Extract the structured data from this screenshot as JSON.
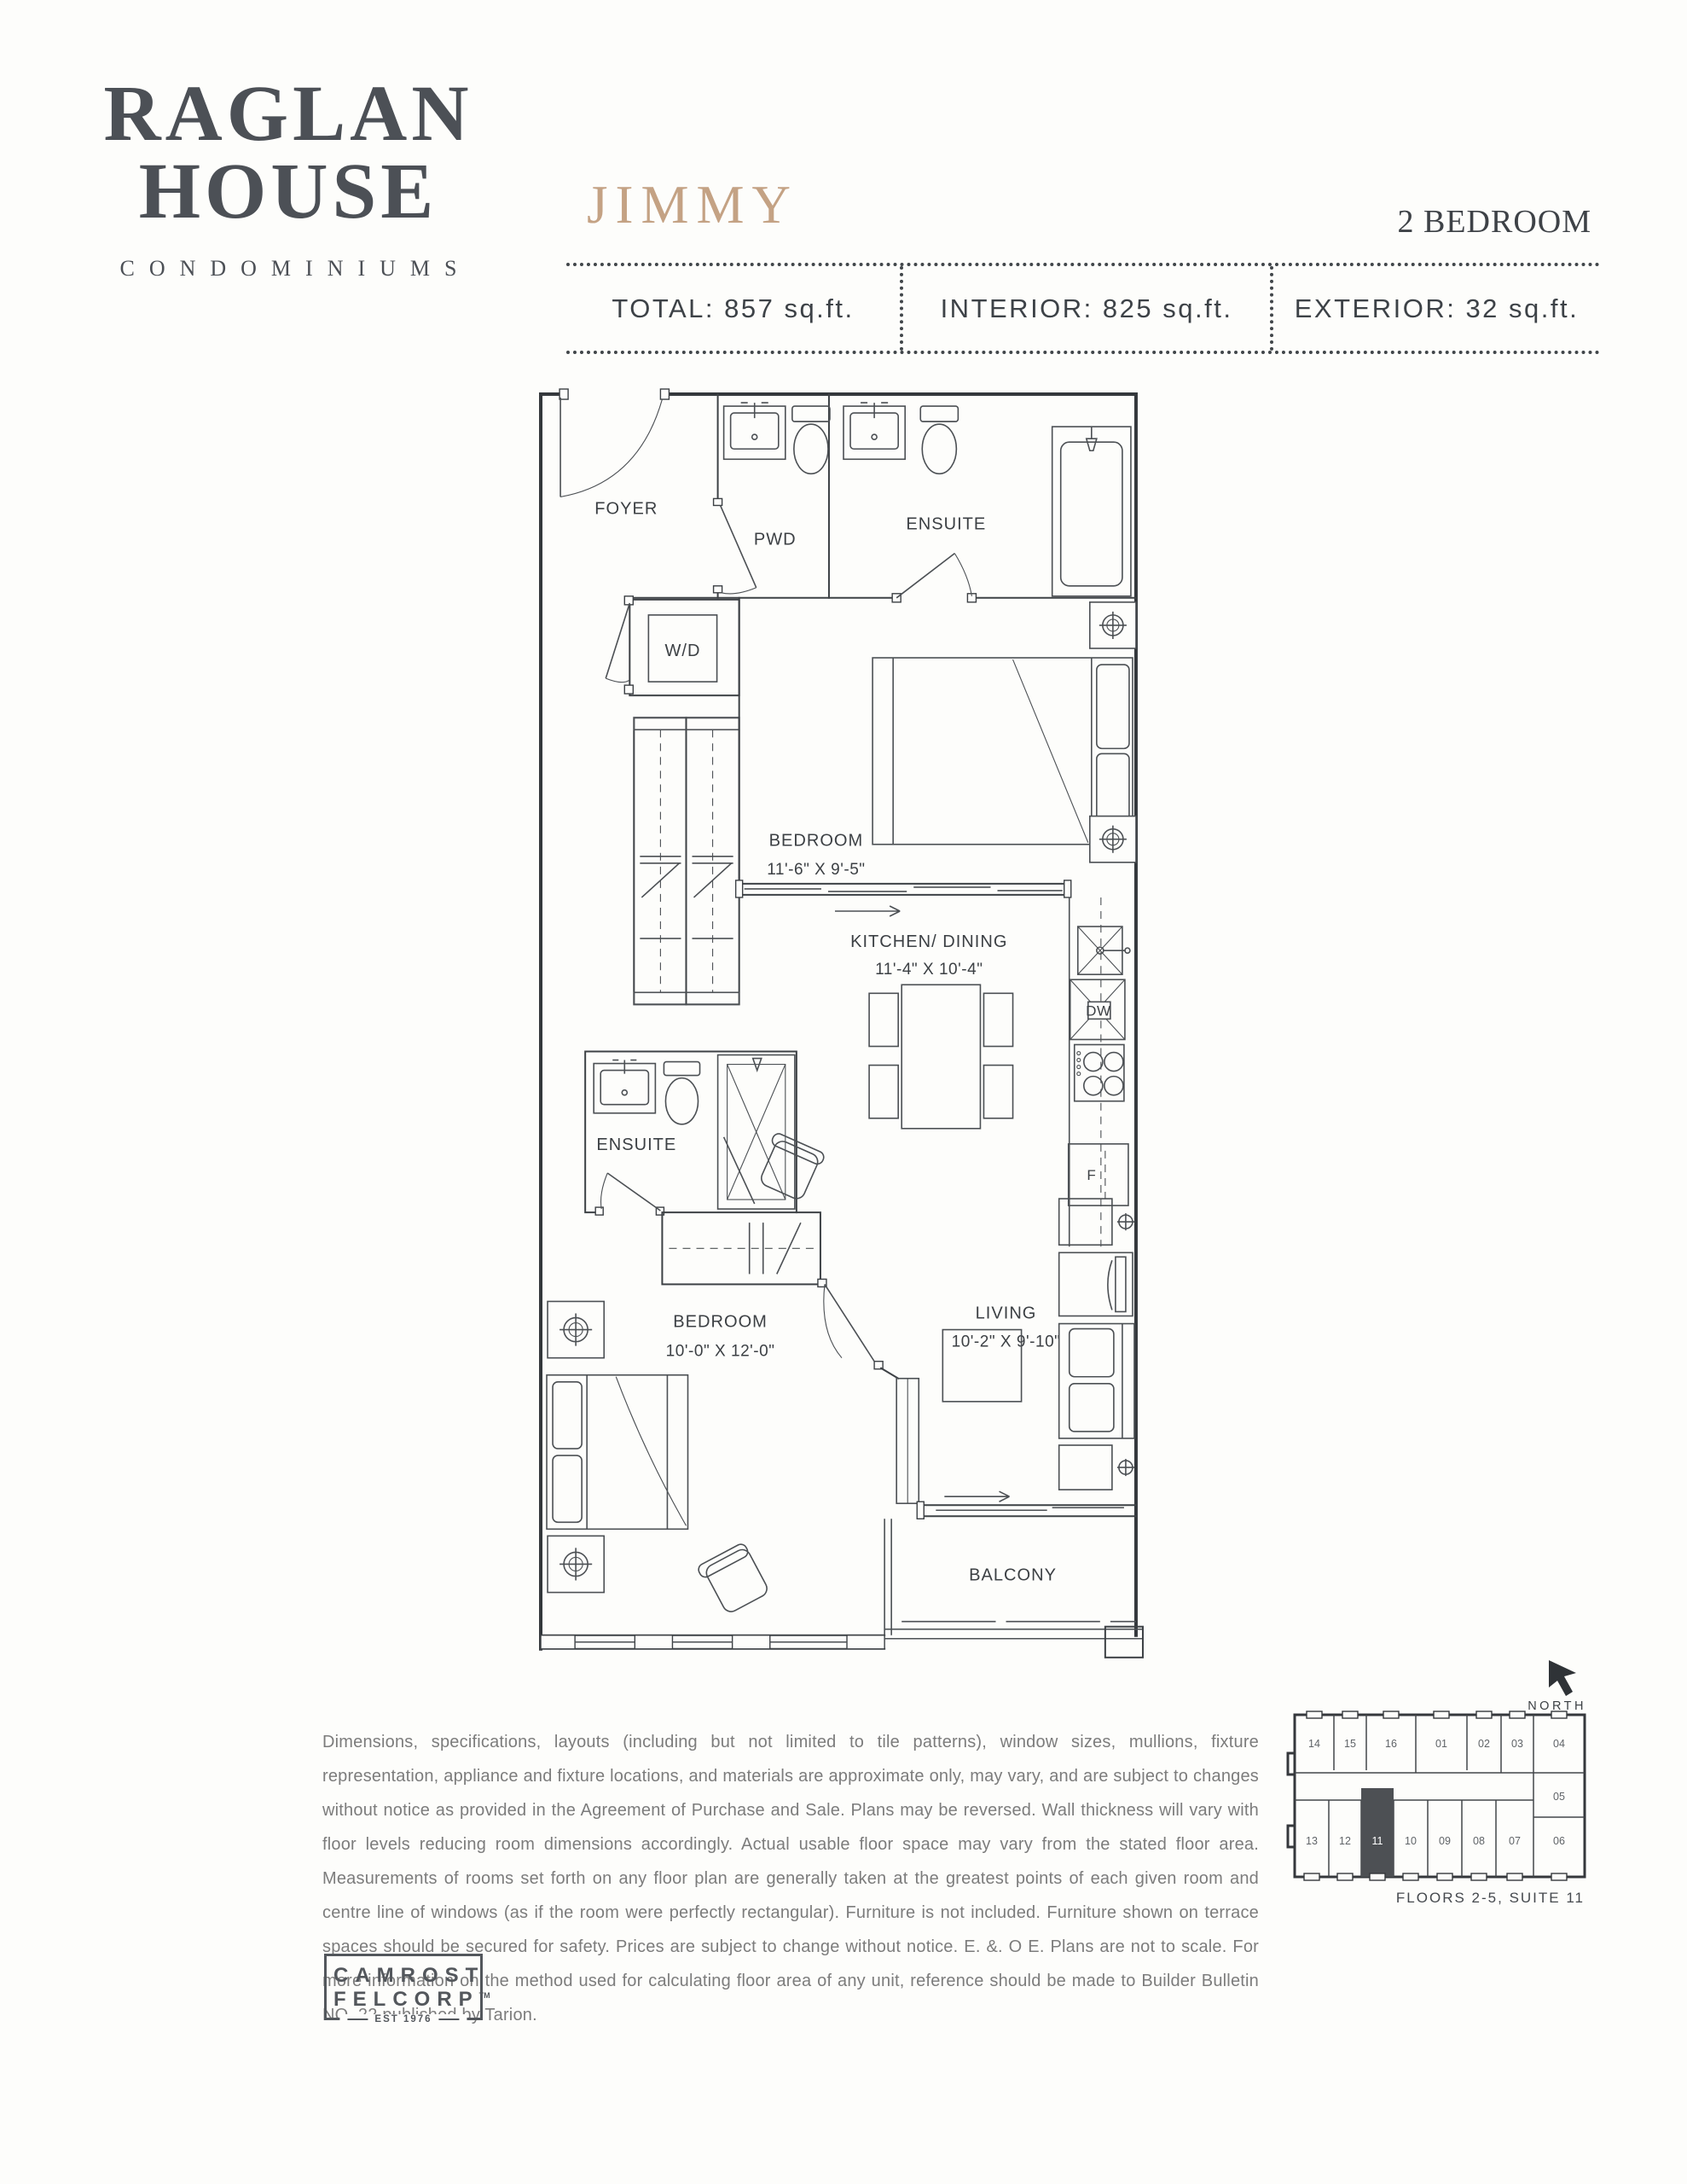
{
  "brand": {
    "name_line1": "RAGLAN",
    "name_line2": "HOUSE",
    "subtitle": "CONDOMINIUMS"
  },
  "header": {
    "plan_name": "JIMMY",
    "plan_type": "2 BEDROOM",
    "stats": [
      "TOTAL: 857 sq.ft.",
      "INTERIOR: 825 sq.ft.",
      "EXTERIOR: 32 sq.ft."
    ]
  },
  "floorplan": {
    "labels": {
      "foyer": "FOYER",
      "pwd": "PWD",
      "ensuite_top": "ENSUITE",
      "wd": "W/D",
      "bedroom1": "BEDROOM",
      "bedroom1_dims": "11'-6\" X 9'-5\"",
      "kitchen": "KITCHEN/ DINING",
      "kitchen_dims": "11'-4\" X 10'-4\"",
      "dw": "DW",
      "fridge": "F",
      "ensuite_lower": "ENSUITE",
      "bedroom2": "BEDROOM",
      "bedroom2_dims": "10'-0\" X 12'-0\"",
      "living": "LIVING",
      "living_dims": "10'-2\" X 9'-10\"",
      "balcony": "BALCONY"
    }
  },
  "keyplan": {
    "north_label": "NORTH",
    "caption": "FLOORS 2-5, SUITE 11",
    "suites_top": [
      "14",
      "15",
      "16",
      "01",
      "02",
      "03",
      "04"
    ],
    "suite_right": "05",
    "suites_bottom": [
      "13",
      "12",
      "11",
      "10",
      "09",
      "08",
      "07",
      "06"
    ],
    "highlighted_suite": "11",
    "highlight_color": "#4d5054"
  },
  "disclaimer": {
    "text": "Dimensions, specifications, layouts (including but not limited to tile patterns), window sizes, mullions, fixture representation, appliance and fixture locations, and materials are approximate only, may vary, and are subject to changes without notice as provided in the Agreement of Purchase and Sale.  Plans may be reversed.  Wall thickness will vary with floor levels reducing room dimensions accordingly. Actual usable floor space may vary from the stated floor area.  Measurements of rooms set forth on any floor plan are generally taken at the greatest points of each given room and centre line of windows (as if the room were perfectly rectangular).  Furniture is not included.  Furniture shown on terrace spaces should be secured for safety.  Prices are subject to change without notice.  E. &. O E. Plans are not to scale. For more information on the method used for calculating floor area of any unit, reference should be made to Builder Bulletin NO. 22 published by Tarion."
  },
  "developer": {
    "line1": "CAMROST",
    "line2": "FELCORP",
    "tm": "TM",
    "est": "EST 1976"
  },
  "colors": {
    "accent_tan": "#c4a284",
    "ink": "#3c4044",
    "wall": "#34383c",
    "muted": "#7c7c7c"
  }
}
